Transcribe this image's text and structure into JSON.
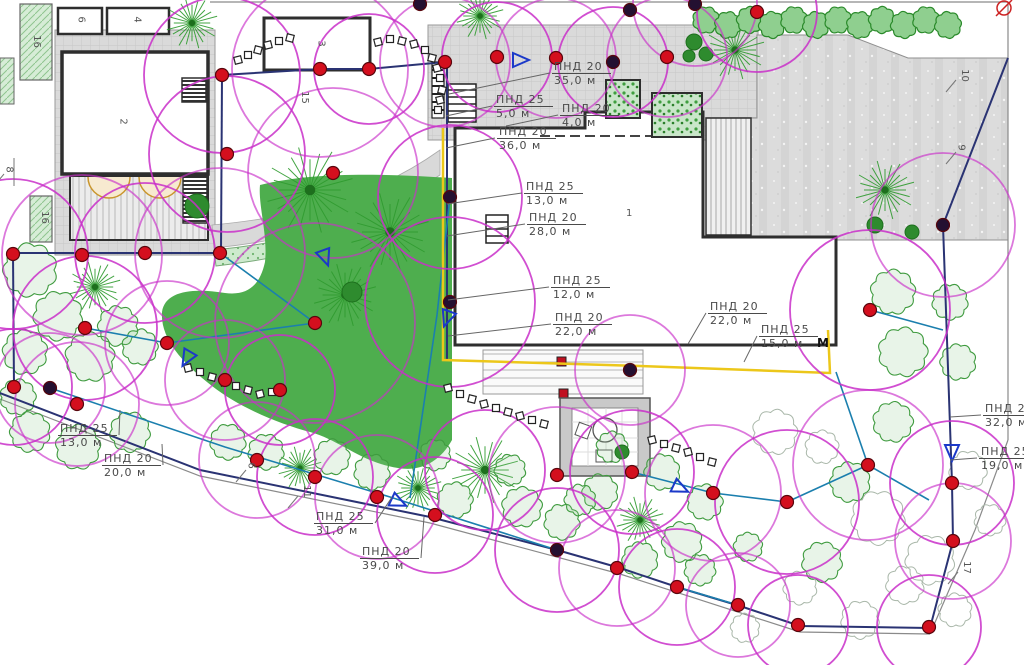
{
  "colors": {
    "coverage": "#c92fc9",
    "sprinkler": "#d40f1e",
    "sprinkler_dark": "#241031",
    "pipe_teal": "#1b7fae",
    "pipe_navy": "#2a3373",
    "main_line_yellow": "#ecc71a",
    "lawn": "#4eae4e",
    "leader": "#666666",
    "boundary_gray": "#8a8a8a"
  },
  "pipe_labels": [
    {
      "name": "ПНД 20",
      "length": "35,0 м",
      "x": 552,
      "y": 60,
      "tx": 449,
      "ty": 94
    },
    {
      "name": "ПНД 25",
      "length": "5,0 м",
      "x": 494,
      "y": 93,
      "tx": 446,
      "ty": 116
    },
    {
      "name": "ПНД 20",
      "length": "4,0 м",
      "x": 560,
      "y": 102,
      "tx": 506,
      "ty": 126
    },
    {
      "name": "ПНД 20",
      "length": "36,0 м",
      "x": 497,
      "y": 125,
      "tx": 446,
      "ty": 148
    },
    {
      "name": "ПНД 25",
      "length": "13,0 м",
      "x": 524,
      "y": 180,
      "tx": 447,
      "ty": 204
    },
    {
      "name": "ПНД 20",
      "length": "28,0 м",
      "x": 527,
      "y": 211,
      "tx": 447,
      "ty": 236
    },
    {
      "name": "ПНД 25",
      "length": "12,0 м",
      "x": 551,
      "y": 274,
      "tx": 448,
      "ty": 300
    },
    {
      "name": "ПНД 20",
      "length": "22,0 м",
      "x": 553,
      "y": 311,
      "tx": 448,
      "ty": 336
    },
    {
      "name": "ПНД 20",
      "length": "22,0 м",
      "x": 708,
      "y": 300,
      "tx": 688,
      "ty": 344
    },
    {
      "name": "ПНД 25",
      "length": "15,0 м",
      "x": 759,
      "y": 323,
      "tx": 744,
      "ty": 362
    },
    {
      "name": "ПНД 20",
      "length": "32,0 м",
      "x": 983,
      "y": 402,
      "tx": 950,
      "ty": 417
    },
    {
      "name": "ПНД 25",
      "length": "19,0 м",
      "x": 979,
      "y": 445,
      "tx": 950,
      "ty": 460
    },
    {
      "name": "ПНД 25",
      "length": "13,0 м",
      "x": 58,
      "y": 422,
      "tx": 120,
      "ty": 410
    },
    {
      "name": "ПНД 20",
      "length": "20,0 м",
      "x": 102,
      "y": 452,
      "tx": 162,
      "ty": 444
    },
    {
      "name": "ПНД 25",
      "length": "31,0 м",
      "x": 314,
      "y": 510,
      "tx": 392,
      "ty": 497
    },
    {
      "name": "ПНД 20",
      "length": "39,0 м",
      "x": 360,
      "y": 545,
      "tx": 424,
      "ty": 517
    }
  ],
  "zone_numbers": [
    {
      "n": "6",
      "x": 78,
      "y": 14,
      "rot": true,
      "hook": false
    },
    {
      "n": "4",
      "x": 134,
      "y": 14,
      "rot": true,
      "hook": false
    },
    {
      "n": "16",
      "x": 30,
      "y": 36,
      "rot": true,
      "hook": false
    },
    {
      "n": "2",
      "x": 120,
      "y": 116,
      "rot": true,
      "hook": false
    },
    {
      "n": "8",
      "x": 6,
      "y": 164,
      "rot": true,
      "hook": true
    },
    {
      "n": "16",
      "x": 38,
      "y": 212,
      "rot": true,
      "hook": false
    },
    {
      "n": "3",
      "x": 318,
      "y": 38,
      "rot": true,
      "hook": false
    },
    {
      "n": "15",
      "x": 298,
      "y": 92,
      "rot": true,
      "hook": false
    },
    {
      "n": "10",
      "x": 958,
      "y": 70,
      "rot": true,
      "hook": true
    },
    {
      "n": "9",
      "x": 958,
      "y": 142,
      "rot": true,
      "hook": true
    },
    {
      "n": "1",
      "x": 626,
      "y": 208,
      "rot": false,
      "hook": false
    },
    {
      "n": "6",
      "x": 248,
      "y": 460,
      "rot": true,
      "hook": true
    },
    {
      "n": "11",
      "x": 300,
      "y": 486,
      "rot": true,
      "hook": true
    },
    {
      "n": "17",
      "x": 960,
      "y": 562,
      "rot": true,
      "hook": true
    }
  ],
  "marker": {
    "text": "М",
    "x": 817,
    "y": 336
  },
  "sprinklers": [
    [
      222,
      75,
      0
    ],
    [
      320,
      69,
      0
    ],
    [
      369,
      69,
      0
    ],
    [
      445,
      62,
      0
    ],
    [
      497,
      57,
      0
    ],
    [
      556,
      58,
      0
    ],
    [
      613,
      62,
      1
    ],
    [
      667,
      57,
      0
    ],
    [
      420,
      4,
      1
    ],
    [
      630,
      10,
      1
    ],
    [
      695,
      4,
      1
    ],
    [
      757,
      12,
      0
    ],
    [
      13,
      254,
      0
    ],
    [
      82,
      255,
      0
    ],
    [
      145,
      253,
      0
    ],
    [
      220,
      253,
      0
    ],
    [
      85,
      328,
      0
    ],
    [
      167,
      343,
      0
    ],
    [
      14,
      387,
      0
    ],
    [
      77,
      404,
      0
    ],
    [
      50,
      388,
      1
    ],
    [
      227,
      154,
      0
    ],
    [
      333,
      173,
      0
    ],
    [
      450,
      197,
      1
    ],
    [
      315,
      323,
      0
    ],
    [
      450,
      302,
      1
    ],
    [
      225,
      380,
      0
    ],
    [
      280,
      390,
      0
    ],
    [
      257,
      460,
      0
    ],
    [
      315,
      477,
      0
    ],
    [
      377,
      497,
      0
    ],
    [
      435,
      515,
      0
    ],
    [
      557,
      475,
      0
    ],
    [
      632,
      472,
      0
    ],
    [
      630,
      370,
      1
    ],
    [
      713,
      493,
      0
    ],
    [
      787,
      502,
      0
    ],
    [
      617,
      568,
      0
    ],
    [
      677,
      587,
      0
    ],
    [
      738,
      605,
      0
    ],
    [
      798,
      625,
      0
    ],
    [
      557,
      550,
      1
    ],
    [
      943,
      225,
      1
    ],
    [
      870,
      310,
      0
    ],
    [
      868,
      465,
      0
    ],
    [
      952,
      483,
      0
    ],
    [
      953,
      541,
      0
    ],
    [
      929,
      627,
      0
    ]
  ],
  "coverage": [
    [
      222,
      75,
      78
    ],
    [
      320,
      69,
      88
    ],
    [
      369,
      69,
      55
    ],
    [
      445,
      62,
      65
    ],
    [
      497,
      57,
      55
    ],
    [
      556,
      58,
      60
    ],
    [
      613,
      62,
      55
    ],
    [
      667,
      57,
      60
    ],
    [
      13,
      254,
      75
    ],
    [
      82,
      255,
      80
    ],
    [
      145,
      253,
      70
    ],
    [
      220,
      253,
      85
    ],
    [
      85,
      328,
      72
    ],
    [
      167,
      343,
      62
    ],
    [
      14,
      387,
      58
    ],
    [
      77,
      404,
      62
    ],
    [
      227,
      154,
      78
    ],
    [
      333,
      173,
      85
    ],
    [
      450,
      197,
      72
    ],
    [
      315,
      323,
      100
    ],
    [
      450,
      302,
      85
    ],
    [
      225,
      380,
      60
    ],
    [
      280,
      390,
      55
    ],
    [
      257,
      460,
      58
    ],
    [
      315,
      477,
      58
    ],
    [
      377,
      497,
      62
    ],
    [
      435,
      515,
      58
    ],
    [
      557,
      475,
      68
    ],
    [
      632,
      472,
      62
    ],
    [
      713,
      493,
      68
    ],
    [
      787,
      502,
      72
    ],
    [
      617,
      568,
      58
    ],
    [
      677,
      587,
      58
    ],
    [
      738,
      605,
      52
    ],
    [
      798,
      625,
      50
    ],
    [
      943,
      225,
      72
    ],
    [
      870,
      310,
      80
    ],
    [
      868,
      465,
      75
    ],
    [
      952,
      483,
      62
    ],
    [
      953,
      541,
      58
    ],
    [
      929,
      627,
      52
    ],
    [
      50,
      388,
      55
    ],
    [
      557,
      550,
      62
    ],
    [
      630,
      370,
      55
    ],
    [
      757,
      12,
      60
    ],
    [
      695,
      4,
      62
    ],
    [
      485,
      470,
      60
    ]
  ],
  "trees": [
    [
      "conifer",
      192,
      23,
      26
    ],
    [
      "conifer",
      480,
      16,
      24
    ],
    [
      "conifer",
      735,
      50,
      30
    ],
    [
      "conifer",
      885,
      190,
      30
    ],
    [
      "conifer",
      310,
      190,
      44
    ],
    [
      "conifer",
      390,
      232,
      40
    ],
    [
      "conifer",
      345,
      295,
      32
    ],
    [
      "conifer",
      95,
      287,
      26
    ],
    [
      "conifer",
      300,
      468,
      22
    ],
    [
      "conifer",
      485,
      470,
      34
    ],
    [
      "conifer",
      640,
      520,
      24
    ],
    [
      "conifer",
      418,
      488,
      24
    ],
    [
      "shrub",
      30,
      270,
      24
    ],
    [
      "shrub",
      58,
      316,
      22
    ],
    [
      "shrub",
      118,
      326,
      18
    ],
    [
      "shrub",
      25,
      352,
      20
    ],
    [
      "shrub",
      90,
      357,
      22
    ],
    [
      "shrub",
      140,
      347,
      16
    ],
    [
      "shrub",
      18,
      397,
      16
    ],
    [
      "shrub",
      30,
      432,
      18
    ],
    [
      "shrub",
      78,
      447,
      20
    ],
    [
      "shrub",
      130,
      432,
      18
    ],
    [
      "shrub",
      228,
      442,
      16
    ],
    [
      "shrub",
      266,
      452,
      16
    ],
    [
      "shrub",
      332,
      457,
      16
    ],
    [
      "shrub",
      372,
      472,
      16
    ],
    [
      "shrub",
      435,
      455,
      14
    ],
    [
      "shrub",
      455,
      500,
      16
    ],
    [
      "shrub",
      510,
      470,
      14
    ],
    [
      "shrub",
      522,
      507,
      18
    ],
    [
      "shrub",
      562,
      522,
      16
    ],
    [
      "shrub",
      600,
      492,
      16
    ],
    [
      "shrub",
      580,
      500,
      14
    ],
    [
      "shrub",
      640,
      560,
      16
    ],
    [
      "shrub",
      682,
      542,
      18
    ],
    [
      "shrub",
      700,
      570,
      14
    ],
    [
      "shrub",
      705,
      502,
      16
    ],
    [
      "shrub",
      748,
      547,
      13
    ],
    [
      "shrub",
      612,
      447,
      14
    ],
    [
      "shrub",
      662,
      472,
      16
    ],
    [
      "shrub",
      893,
      292,
      20
    ],
    [
      "shrub",
      950,
      302,
      16
    ],
    [
      "shrub",
      903,
      352,
      22
    ],
    [
      "shrub",
      958,
      362,
      16
    ],
    [
      "shrub",
      893,
      422,
      18
    ],
    [
      "shrub",
      850,
      482,
      18
    ],
    [
      "shrub",
      822,
      562,
      18
    ],
    [
      "pale",
      775,
      432,
      20
    ],
    [
      "pale",
      822,
      447,
      15
    ],
    [
      "pale",
      878,
      518,
      24
    ],
    [
      "pale",
      930,
      560,
      22
    ],
    [
      "pale",
      968,
      470,
      17
    ],
    [
      "pale",
      905,
      585,
      17
    ],
    [
      "pale",
      955,
      610,
      15
    ],
    [
      "pale",
      860,
      620,
      17
    ],
    [
      "pale",
      800,
      588,
      15
    ],
    [
      "pale",
      745,
      628,
      13
    ],
    [
      "pale",
      990,
      520,
      14
    ],
    [
      "blob",
      197,
      206,
      12
    ],
    [
      "blob",
      352,
      292,
      10
    ],
    [
      "blob",
      694,
      42,
      8
    ],
    [
      "blob",
      706,
      54,
      7
    ],
    [
      "blob",
      689,
      56,
      6
    ],
    [
      "blob",
      875,
      225,
      8
    ],
    [
      "blob",
      912,
      232,
      7
    ],
    [
      "blob",
      622,
      452,
      7
    ]
  ],
  "hedge": {
    "x_start": 706,
    "x_end": 948,
    "y": 22,
    "r": 12,
    "count": 12
  },
  "valve_triangles": [
    [
      325,
      257,
      160
    ],
    [
      447,
      318,
      200
    ],
    [
      187,
      358,
      210
    ],
    [
      398,
      502,
      115
    ],
    [
      680,
      488,
      115
    ],
    [
      952,
      452,
      180
    ],
    [
      520,
      60,
      90
    ]
  ],
  "stepping_stones": [
    [
      [
        238,
        60
      ],
      [
        248,
        55
      ],
      [
        258,
        50
      ],
      [
        268,
        45
      ],
      [
        279,
        41
      ],
      [
        290,
        38
      ]
    ],
    [
      [
        378,
        42
      ],
      [
        390,
        39
      ],
      [
        402,
        41
      ],
      [
        414,
        44
      ],
      [
        425,
        50
      ],
      [
        432,
        58
      ],
      [
        437,
        68
      ],
      [
        440,
        78
      ],
      [
        442,
        90
      ],
      [
        440,
        100
      ],
      [
        438,
        110
      ]
    ],
    [
      [
        188,
        368
      ],
      [
        200,
        372
      ],
      [
        212,
        377
      ],
      [
        224,
        382
      ],
      [
        236,
        386
      ],
      [
        248,
        390
      ],
      [
        260,
        394
      ],
      [
        272,
        392
      ]
    ],
    [
      [
        448,
        388
      ],
      [
        460,
        394
      ],
      [
        472,
        399
      ],
      [
        484,
        404
      ],
      [
        496,
        408
      ],
      [
        508,
        412
      ],
      [
        520,
        416
      ],
      [
        532,
        420
      ],
      [
        544,
        424
      ]
    ],
    [
      [
        652,
        440
      ],
      [
        664,
        444
      ],
      [
        676,
        448
      ],
      [
        688,
        452
      ],
      [
        700,
        457
      ],
      [
        712,
        462
      ]
    ]
  ],
  "pipes": {
    "navy": [
      [
        [
          222,
          75
        ],
        [
          320,
          69
        ],
        [
          369,
          69
        ],
        [
          445,
          62
        ]
      ],
      [
        [
          222,
          75
        ],
        [
          221,
          253
        ]
      ],
      [
        [
          13,
          253
        ],
        [
          221,
          253
        ]
      ],
      [
        [
          13,
          253
        ],
        [
          14,
          388
        ]
      ],
      [
        [
          447,
          62
        ],
        [
          447,
          360
        ]
      ],
      [
        [
          0,
          393
        ],
        [
          200,
          470
        ],
        [
          430,
          517
        ],
        [
          557,
          550
        ],
        [
          620,
          568
        ],
        [
          680,
          588
        ],
        [
          740,
          606
        ],
        [
          800,
          626
        ],
        [
          930,
          628
        ]
      ],
      [
        [
          930,
          628
        ],
        [
          953,
          541
        ],
        [
          952,
          483
        ],
        [
          943,
          225
        ]
      ],
      [
        [
          943,
          225
        ],
        [
          1008,
          58
        ]
      ]
    ],
    "teal": [
      [
        [
          450,
          197
        ],
        [
          437,
          315
        ],
        [
          410,
          498
        ]
      ],
      [
        [
          315,
          323
        ],
        [
          167,
          343
        ],
        [
          85,
          328
        ]
      ],
      [
        [
          220,
          253
        ],
        [
          315,
          323
        ]
      ],
      [
        [
          50,
          388
        ],
        [
          225,
          447
        ],
        [
          390,
          497
        ],
        [
          557,
          550
        ]
      ],
      [
        [
          632,
          472
        ],
        [
          713,
          493
        ],
        [
          787,
          502
        ]
      ],
      [
        [
          677,
          587
        ],
        [
          738,
          605
        ]
      ],
      [
        [
          870,
          310
        ],
        [
          943,
          330
        ]
      ],
      [
        [
          868,
          465
        ],
        [
          929,
          500
        ]
      ],
      [
        [
          787,
          502
        ],
        [
          868,
          465
        ]
      ],
      [
        [
          836,
          372
        ],
        [
          868,
          465
        ]
      ]
    ],
    "outer": [
      [
        [
          210,
          2
        ],
        [
          1008,
          2
        ]
      ],
      [
        [
          1008,
          2
        ],
        [
          1008,
          440
        ]
      ],
      [
        [
          1008,
          440
        ],
        [
          975,
          530
        ],
        [
          930,
          634
        ]
      ],
      [
        [
          0,
          399
        ],
        [
          200,
          476
        ],
        [
          430,
          523
        ],
        [
          620,
          574
        ],
        [
          800,
          632
        ],
        [
          930,
          634
        ]
      ]
    ],
    "main_yellow": [
      [
        [
          443,
          128
        ],
        [
          443,
          360
        ],
        [
          640,
          366
        ],
        [
          830,
          373
        ],
        [
          828,
          330
        ]
      ]
    ]
  }
}
